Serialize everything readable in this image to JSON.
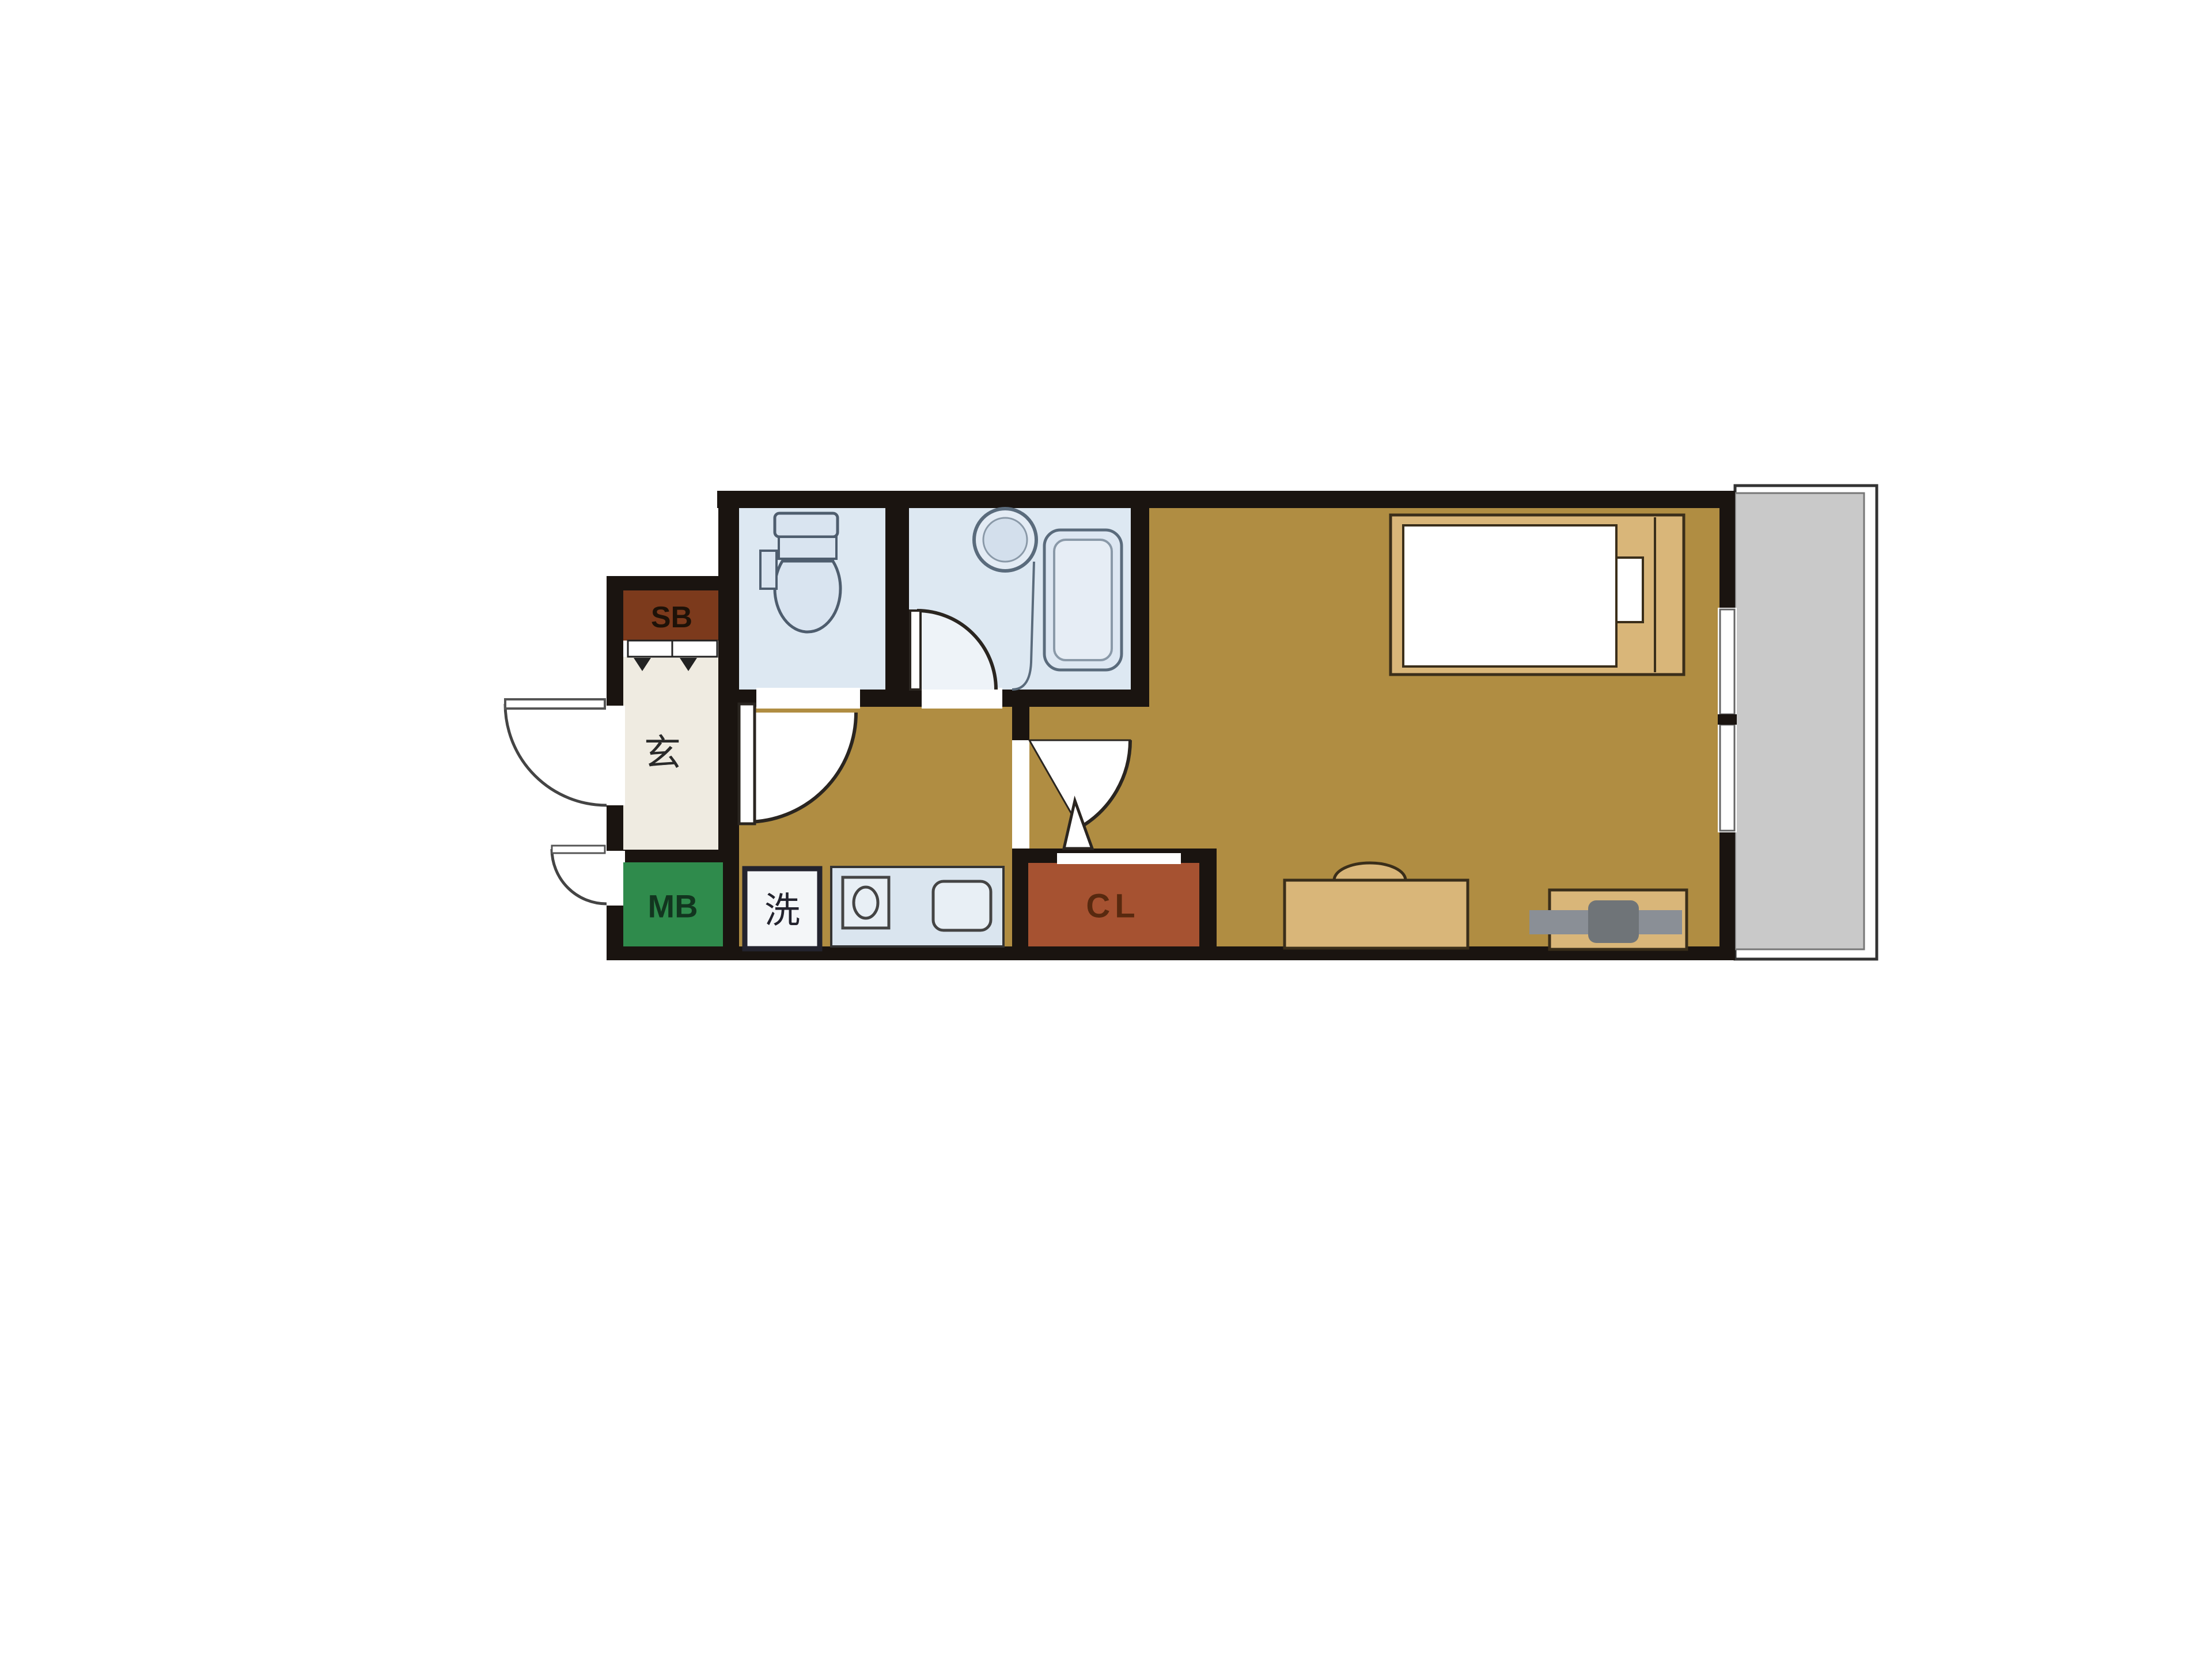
{
  "plan": {
    "type": "apartment-floor-plan",
    "labels": {
      "shoe_box": "SB",
      "entrance": "玄",
      "meter_box": "MB",
      "washer": "洗",
      "closet": "CL"
    },
    "rooms": [
      {
        "id": "entrance",
        "label": "玄"
      },
      {
        "id": "shoe-box",
        "label": "SB"
      },
      {
        "id": "meter-box",
        "label": "MB"
      },
      {
        "id": "toilet",
        "label": ""
      },
      {
        "id": "bathroom",
        "label": ""
      },
      {
        "id": "kitchen-hallway",
        "label": ""
      },
      {
        "id": "washer-space",
        "label": "洗"
      },
      {
        "id": "closet",
        "label": "CL"
      },
      {
        "id": "main-room",
        "label": ""
      },
      {
        "id": "balcony",
        "label": ""
      }
    ],
    "colors": {
      "wall": "#1a1410",
      "floor": "#b08d42",
      "wet_room": "#dde8f2",
      "fixture_fill": "#d9e4f0",
      "fixture_stroke": "#4e5d6e",
      "entrance_floor": "#efebe1",
      "shoe_box": "#7c3a1c",
      "meter_box": "#2f8b4c",
      "closet": "#a65231",
      "counter": "#dae5ef",
      "furniture_tan": "#d9b679",
      "balcony_gray": "#c9c9c9",
      "tv_gray": "#8a8f96",
      "tv_dark": "#6f7478",
      "door_line": "#2a2520"
    }
  }
}
